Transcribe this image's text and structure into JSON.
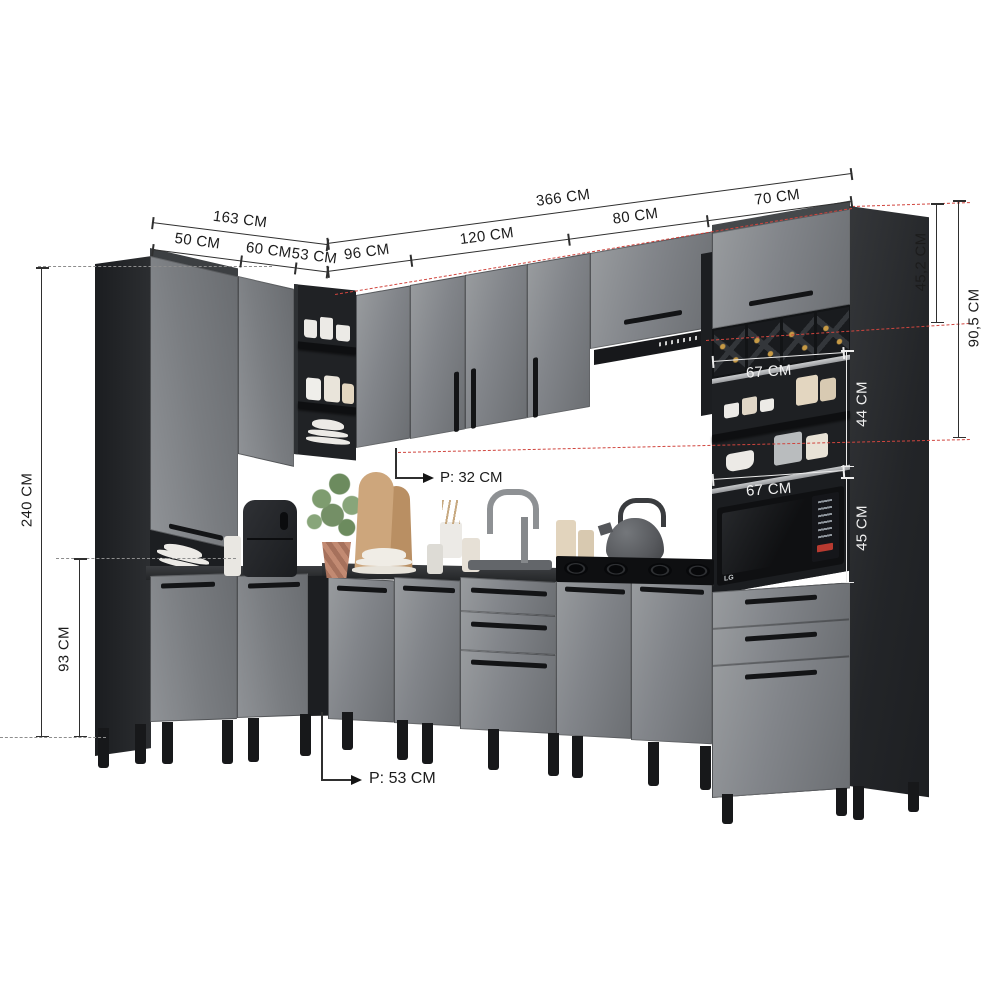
{
  "colors": {
    "door_gray": "#82858a",
    "carcass_dark": "#26282b",
    "counter": "#2a2c2f",
    "dim_line": "#2f2f2f",
    "dim_red_dashed": "#d0453e",
    "interior_light_band": "#c9cbcd"
  },
  "dimensions": {
    "top_total": "366 CM",
    "top_seg_120": "120 CM",
    "top_seg_80": "80 CM",
    "top_seg_70": "70 CM",
    "left_total": "163 CM",
    "left_seg_50": "50 CM",
    "left_seg_60": "60 CM",
    "left_seg_53": "53 CM",
    "right_seg_96": "96 CM",
    "height_total": "240 CM",
    "height_base": "93 CM",
    "right_top_door": "45,2 CM",
    "right_upper_total": "90,5 CM",
    "right_open_shelf": "44 CM",
    "right_microwave_niche": "45 CM",
    "niche_width_top": "67 CM",
    "niche_width_bottom": "67 CM",
    "depth_wall_cabinets": "P: 32 CM",
    "depth_base_cabinets": "P: 53 CM"
  },
  "appliances": {
    "microwave_brand": "LG"
  }
}
